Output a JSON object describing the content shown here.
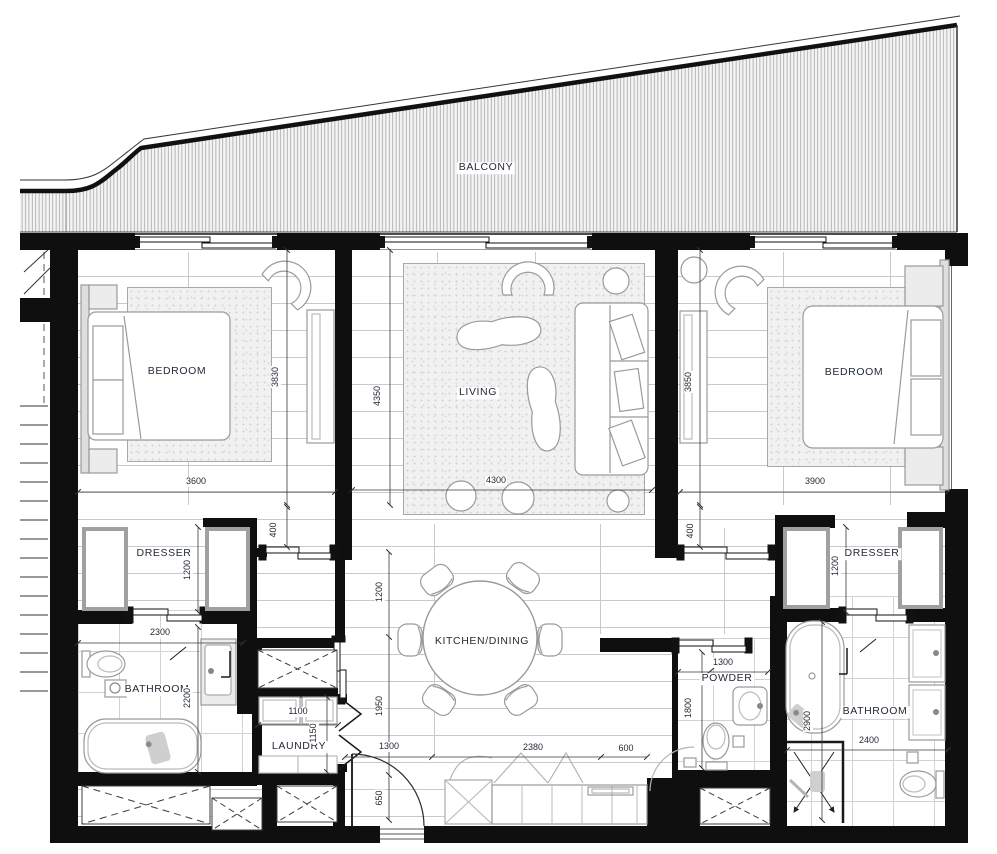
{
  "balcony": {
    "label": "BALCONY"
  },
  "rooms": {
    "bedroom_left": "BEDROOM",
    "living": "LIVING",
    "bedroom_right": "BEDROOM",
    "dresser_left": "DRESSER",
    "dresser_right": "DRESSER",
    "kitchen_dining": "KITCHEN/DINING",
    "bathroom_left": "BATHROOM",
    "laundry": "LAUNDRY",
    "powder": "POWDER",
    "bathroom_right": "BATHROOM"
  },
  "dimensions_mm": {
    "bedroom_left_width": "3600",
    "bedroom_left_depth": "3830",
    "living_width": "4300",
    "living_depth": "4350",
    "bedroom_right_width": "3900",
    "bedroom_right_depth": "3850",
    "door_return_left": "400",
    "door_return_right": "400",
    "dresser_left_depth": "1200",
    "dresser_right_depth": "1200",
    "bathroom_left_width": "2300",
    "bathroom_left_depth": "2200",
    "laundry_width": "1100",
    "laundry_depth": "1150",
    "kitchen_depth_upper": "1200",
    "kitchen_depth_lower": "1950",
    "entry_depth": "650",
    "hall_width_left": "1300",
    "kitchen_width": "2380",
    "kitchen_gap": "600",
    "powder_width": "1300",
    "powder_depth": "1800",
    "bathroom_right_width": "2400",
    "bathroom_right_depth": "2900"
  },
  "colors": {
    "wall": "#0f0f0f",
    "furniture_line": "#9a9a9a",
    "floor_line": "#c9c9c9",
    "label_text": "#232b36"
  }
}
